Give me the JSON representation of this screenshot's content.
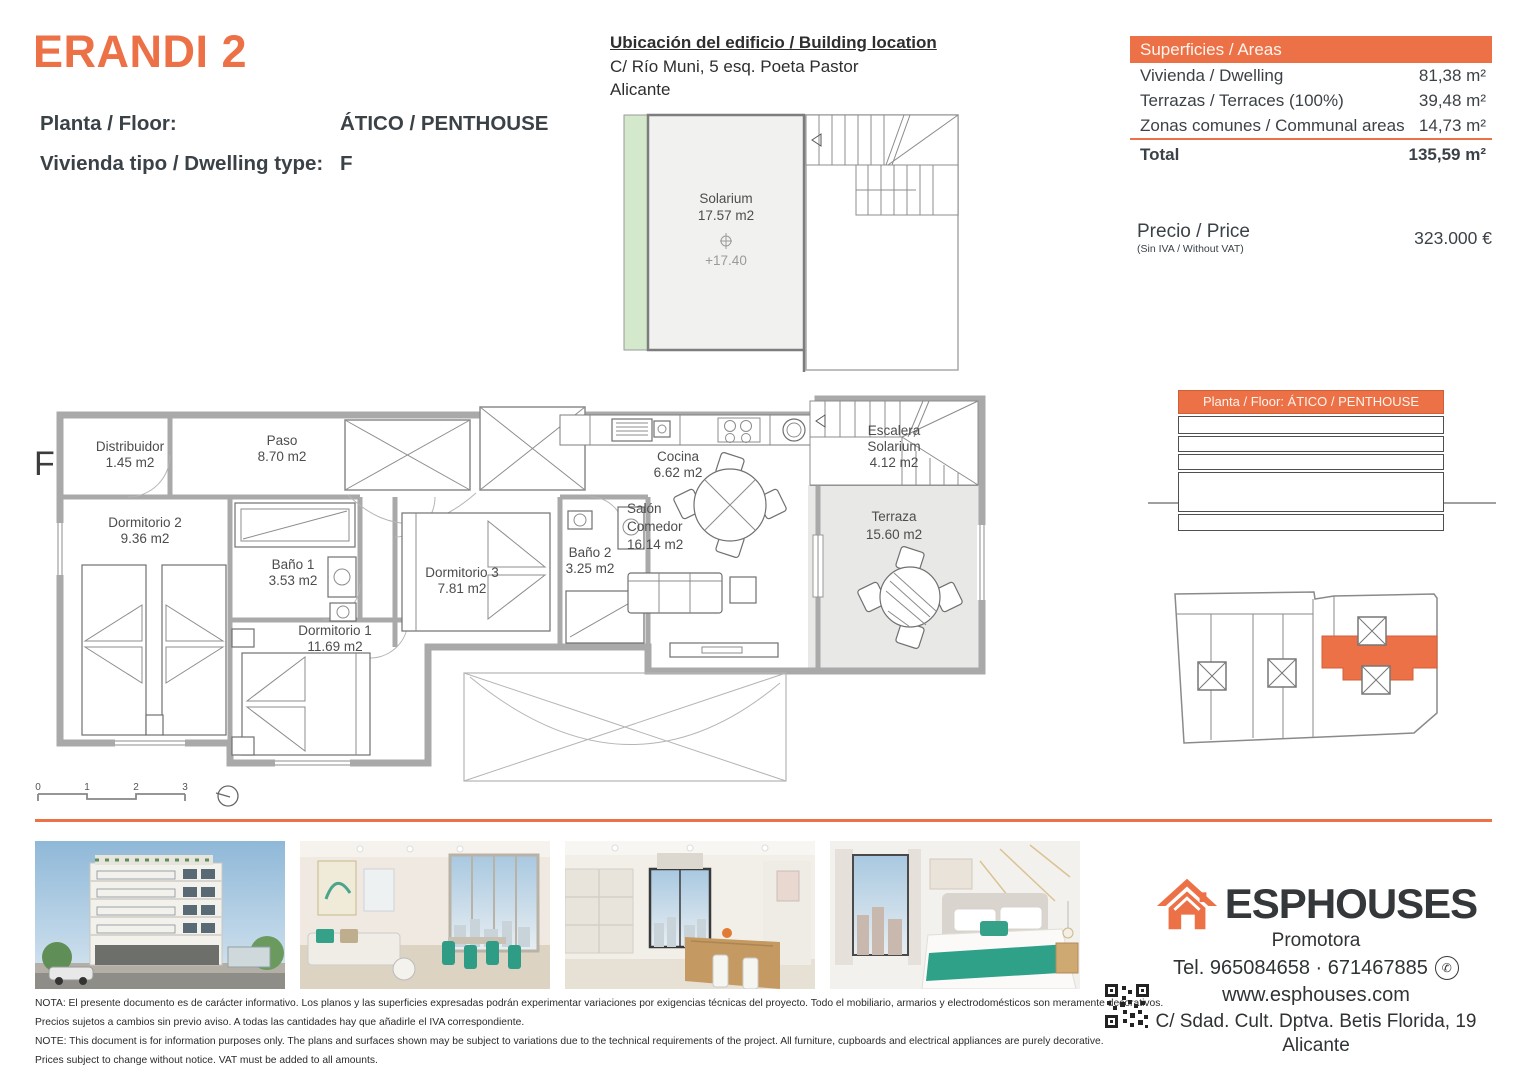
{
  "accent": "#ED7146",
  "header": {
    "title": "ERANDI 2",
    "floor_label": "Planta / Floor:",
    "floor_value": "ÁTICO / PENTHOUSE",
    "dwelling_label": "Vivienda tipo / Dwelling type:",
    "dwelling_value": "F"
  },
  "location": {
    "title": "Ubicación del edificio / Building location",
    "address1": "C/ Río Muni, 5 esq. Poeta Pastor",
    "address2": "Alicante"
  },
  "areas": {
    "header": "Superficies / Areas",
    "rows": [
      {
        "label": "Vivienda / Dwelling",
        "value": "81,38 m²"
      },
      {
        "label": "Terrazas / Terraces (100%)",
        "value": "39,48 m²"
      },
      {
        "label": "Zonas comunes / Communal areas",
        "value": "14,73 m²"
      }
    ],
    "total_label": "Total",
    "total_value": "135,59 m²"
  },
  "price": {
    "label": "Precio / Price",
    "sublabel": "(Sin IVA / Without VAT)",
    "value": "323.000 €"
  },
  "solarium": {
    "name": "Solarium",
    "area": "17.57 m2",
    "level": "+17.40"
  },
  "plan": {
    "type_letter": "F",
    "distribuidor": {
      "name": "Distribuidor",
      "area": "1.45 m2"
    },
    "dormitorio2": {
      "name": "Dormitorio 2",
      "area": "9.36 m2"
    },
    "paso": {
      "name": "Paso",
      "area": "8.70 m2"
    },
    "bano1": {
      "name": "Baño 1",
      "area": "3.53 m2"
    },
    "dormitorio1": {
      "name": "Dormitorio 1",
      "area": "11.69 m2"
    },
    "dormitorio3": {
      "name": "Dormitorio 3",
      "area": "7.81 m2"
    },
    "bano2": {
      "name": "Baño 2",
      "area": "3.25 m2"
    },
    "cocina": {
      "name": "Cocina",
      "area": "6.62 m2"
    },
    "salon": {
      "name1": "Salón",
      "name2": "Comedor",
      "area": "16.14 m2"
    },
    "escalera": {
      "name1": "Escalera",
      "name2": "Solarium",
      "area": "4.12 m2"
    },
    "terraza": {
      "name": "Terraza",
      "area": "15.60 m2"
    }
  },
  "scale": {
    "ticks": [
      "0",
      "1",
      "2",
      "3"
    ]
  },
  "floor_table": {
    "header": "Planta / Floor: ÁTICO / PENTHOUSE"
  },
  "icons": {
    "whatsapp": "✆"
  },
  "footer": {
    "brand": "ESPHOUSES",
    "brand_sub": "Promotora",
    "phone": "Tel. 965084658 · 671467885",
    "website": "www.esphouses.com",
    "address1": "C/ Sdad. Cult. Dptva. Betis Florida, 19",
    "address2": "Alicante"
  },
  "disclaimer": {
    "line1": "NOTA: El presente documento es de carácter informativo. Los planos y las superficies expresadas podrán experimentar variaciones por exigencias técnicas del proyecto. Todo el mobiliario, armarios y electrodomésticos son meramente decorativos.",
    "line2": "Precios sujetos a cambios sin previo aviso. A todas las cantidades hay que añadirle el IVA correspondiente.",
    "line3": "NOTE: This document is for information purposes only. The plans and surfaces shown may be subject to variations due to the technical requirements of the project. All furniture, cupboards and electrical appliances are purely decorative.",
    "line4": "Prices subject to change without notice. VAT must be added to all amounts."
  }
}
